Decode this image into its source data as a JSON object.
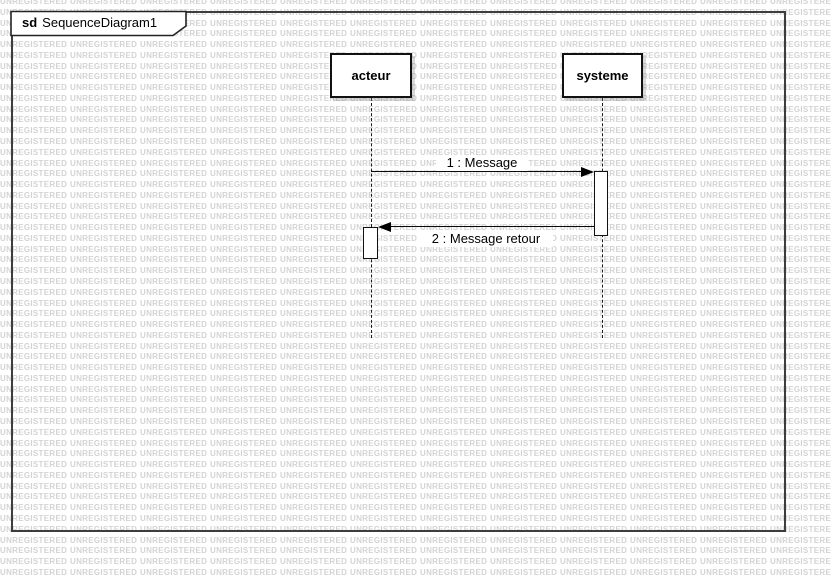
{
  "frame": {
    "keyword": "sd",
    "title": "SequenceDiagram1"
  },
  "lifelines": [
    {
      "name": "acteur"
    },
    {
      "name": "systeme"
    }
  ],
  "messages": [
    {
      "label": "1 : Message",
      "direction": "left-to-right"
    },
    {
      "label": "2 : Message retour",
      "direction": "right-to-left"
    }
  ],
  "watermark": {
    "text": "UNREGISTERED",
    "color": "#d3d3d3"
  },
  "colors": {
    "background": "#ffffff",
    "shape_border": "#111111",
    "frame_border": "#3d3d3d",
    "message_line": "#0a0a0a"
  }
}
